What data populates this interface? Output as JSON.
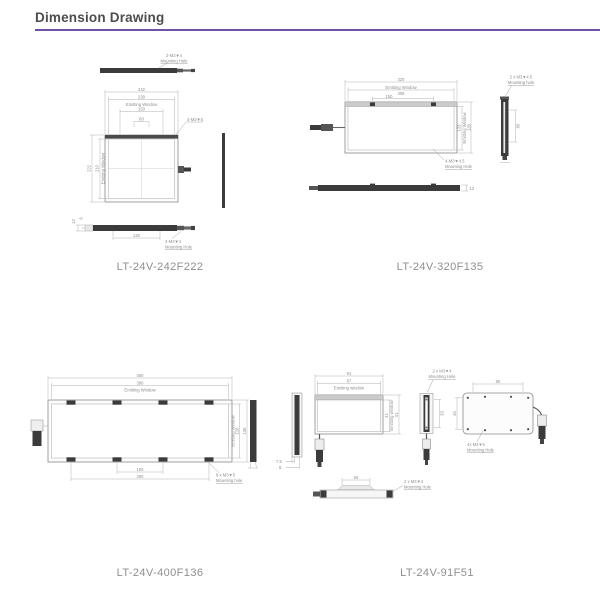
{
  "page": {
    "title": "Dimension Drawing",
    "accent_color": "#6f52a5",
    "title_color": "#4d4d4d",
    "label_color": "#8f8f8f"
  },
  "labels": {
    "d242": "LT-24V-242F222",
    "d320": "LT-24V-320F135",
    "d400": "LT-24V-400F136",
    "d91": "LT-24V-91F51"
  },
  "d242": {
    "top_ann1": "2-M3▼4",
    "top_ann2": "Mounting Hole",
    "w_outer": "242",
    "w_win": "230",
    "win_label": "Emitting Window",
    "w_holes": "150",
    "w_holes2": "60",
    "corner_ann": "4-M3▼5",
    "h_outer": "222",
    "h_win": "210",
    "h_win_label": "Emitting Window",
    "thk1": "12",
    "thk2": "9",
    "bottom_span": "120",
    "bot_ann1": "2-M3▼4",
    "bot_ann2": "Mounting Hole"
  },
  "d320": {
    "w_outer": "320",
    "w_win": "308",
    "win_label": "Emitting Window",
    "w_holes": "150",
    "h_win": "123",
    "h_outer": "135",
    "h_win_label": "Emitting Window",
    "front_ann1": "4-M3▼4.5",
    "front_ann2": "Mounting Hole",
    "side_ann1": "2 x M3▼4.5",
    "side_ann2": "Mounting hole",
    "side_span": "80",
    "thk": "12"
  },
  "d400": {
    "w_outer": "400",
    "w_win": "390",
    "win_label": "Emitting Window",
    "h_win": "126",
    "h_outer": "136",
    "h_win_label": "Emitting Window",
    "bottom_span1": "100",
    "bottom_span2": "300",
    "bot_ann1": "8 x M3▼5",
    "bot_ann2": "Mounting hole"
  },
  "d91": {
    "side_thk1": "7.5",
    "side_thk2": "8",
    "w_outer": "91",
    "w_win": "87",
    "win_label": "Emitting window",
    "h_win": "41",
    "h_outer": "51",
    "h_win_label": "Emitting window",
    "mid_ann1": "2 x M3▼4",
    "mid_ann2": "Mounting Hole",
    "mid_span": "33",
    "back_w": "80",
    "back_h": "46",
    "back_ann1": "4x M3▼5",
    "back_ann2": "Mounting Hole",
    "bottom_span": "50",
    "bot_ann1": "2 x M3▼4",
    "bot_ann2": "Mounting Hole"
  }
}
